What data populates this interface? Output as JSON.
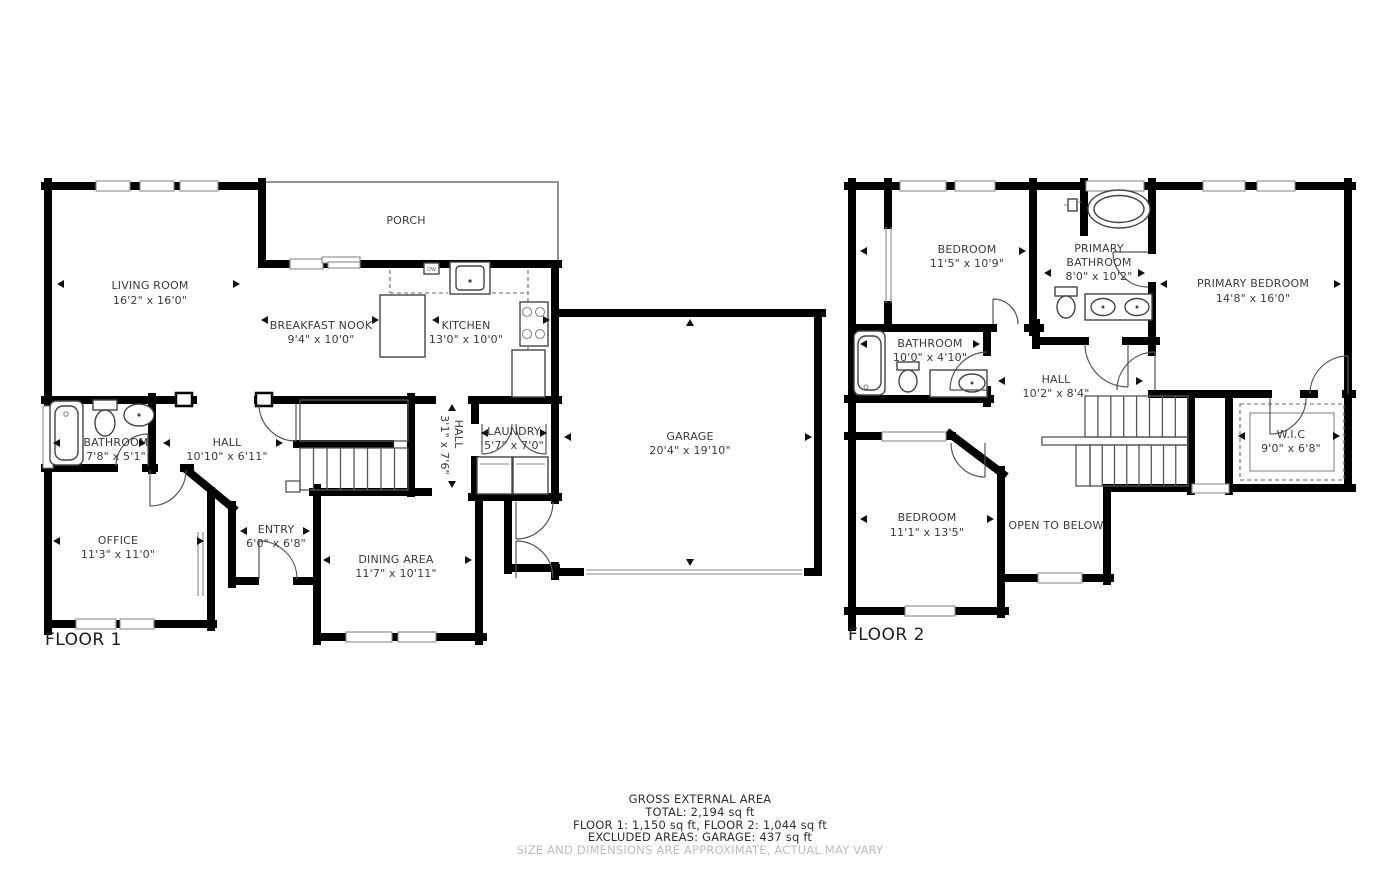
{
  "colors": {
    "wall": "#000000",
    "label": "#3a3a3a",
    "muted": "#bdbdbd"
  },
  "floor1": {
    "label": "FLOOR 1",
    "rooms": {
      "porch": {
        "name": "PORCH",
        "dims": ""
      },
      "living": {
        "name": "LIVING ROOM",
        "dims": "16'2\" x 16'0\""
      },
      "breakfast": {
        "name": "BREAKFAST NOOK",
        "dims": "9'4\" x 10'0\""
      },
      "kitchen": {
        "name": "KITCHEN",
        "dims": "13'0\" x 10'0\""
      },
      "garage": {
        "name": "GARAGE",
        "dims": "20'4\" x 19'10\""
      },
      "bathroom": {
        "name": "BATHROOM",
        "dims": "7'8\" x 5'1\""
      },
      "hall": {
        "name": "HALL",
        "dims": "10'10\" x 6'11\""
      },
      "hall2": {
        "name": "HALL",
        "dims": "3'1\" x 7'6\""
      },
      "laundry": {
        "name": "LAUNDRY",
        "dims": "5'7\" x 7'0\""
      },
      "office": {
        "name": "OFFICE",
        "dims": "11'3\" x 11'0\""
      },
      "entry": {
        "name": "ENTRY",
        "dims": "6'0\" x 6'8\""
      },
      "dining": {
        "name": "DINING AREA",
        "dims": "11'7\" x 10'11\""
      }
    },
    "appliances": {
      "dishwasher": "DW"
    }
  },
  "floor2": {
    "label": "FLOOR 2",
    "rooms": {
      "bedroom1": {
        "name": "BEDROOM",
        "dims": "11'5\" x 10'9\""
      },
      "primary_bathroom": {
        "line1": "PRIMARY",
        "line2": "BATHROOM",
        "dims": "8'0\" x 10'2\""
      },
      "primary_bedroom": {
        "name": "PRIMARY BEDROOM",
        "dims": "14'8\" x 16'0\""
      },
      "bathroom": {
        "name": "BATHROOM",
        "dims": "10'0\" x 4'10\""
      },
      "hall": {
        "name": "HALL",
        "dims": "10'2\" x 8'4\""
      },
      "wic": {
        "name": "W.I.C",
        "dims": "9'0\" x 6'8\""
      },
      "bedroom2": {
        "name": "BEDROOM",
        "dims": "11'1\" x 13'5\""
      },
      "open_below": {
        "name": "OPEN TO BELOW",
        "dims": ""
      }
    }
  },
  "footer": {
    "line1": "GROSS EXTERNAL AREA",
    "line2": "TOTAL: 2,194 sq ft",
    "line3": "FLOOR 1: 1,150 sq ft, FLOOR 2: 1,044 sq ft",
    "line4": "EXCLUDED AREAS: GARAGE: 437 sq ft",
    "disclaimer": "SIZE AND DIMENSIONS ARE APPROXIMATE, ACTUAL MAY VARY"
  }
}
